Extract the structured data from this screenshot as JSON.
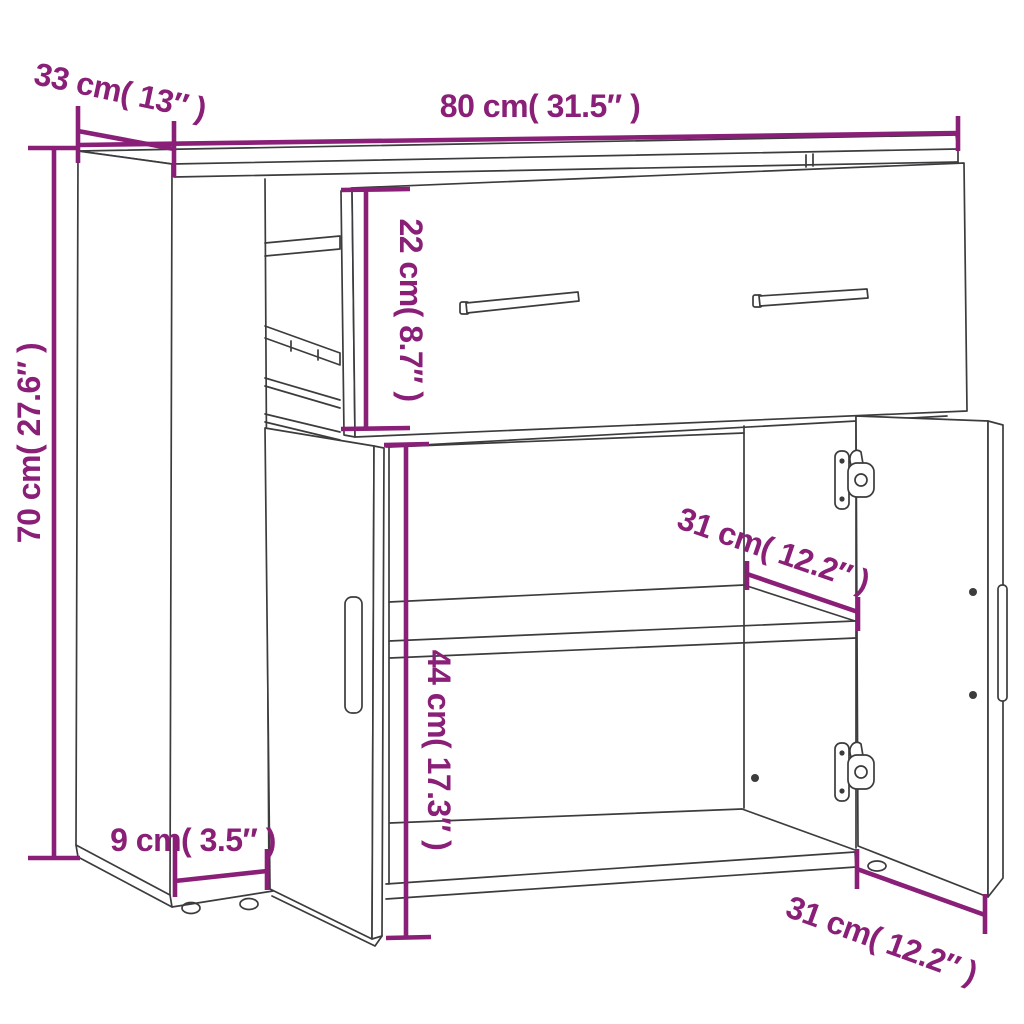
{
  "title": "Sideboard dimension diagram",
  "colors": {
    "dimension_text": "#8a1f78",
    "line_art": "#3c3c3e",
    "background": "#ffffff"
  },
  "dimensions": {
    "top_width": "80 cm( 31.5″ )",
    "top_depth": "33 cm( 13″ )",
    "overall_height": "70 cm( 27.6″ )",
    "drawer_front_height": "22 cm( 8.7″ )",
    "shelf_depth": "31 cm( 12.2″ )",
    "door_compartment_height": "44 cm( 17.3″ )",
    "plinth_depth": "9 cm( 3.5″ )",
    "bottom_depth": "31 cm( 12.2″ )"
  }
}
